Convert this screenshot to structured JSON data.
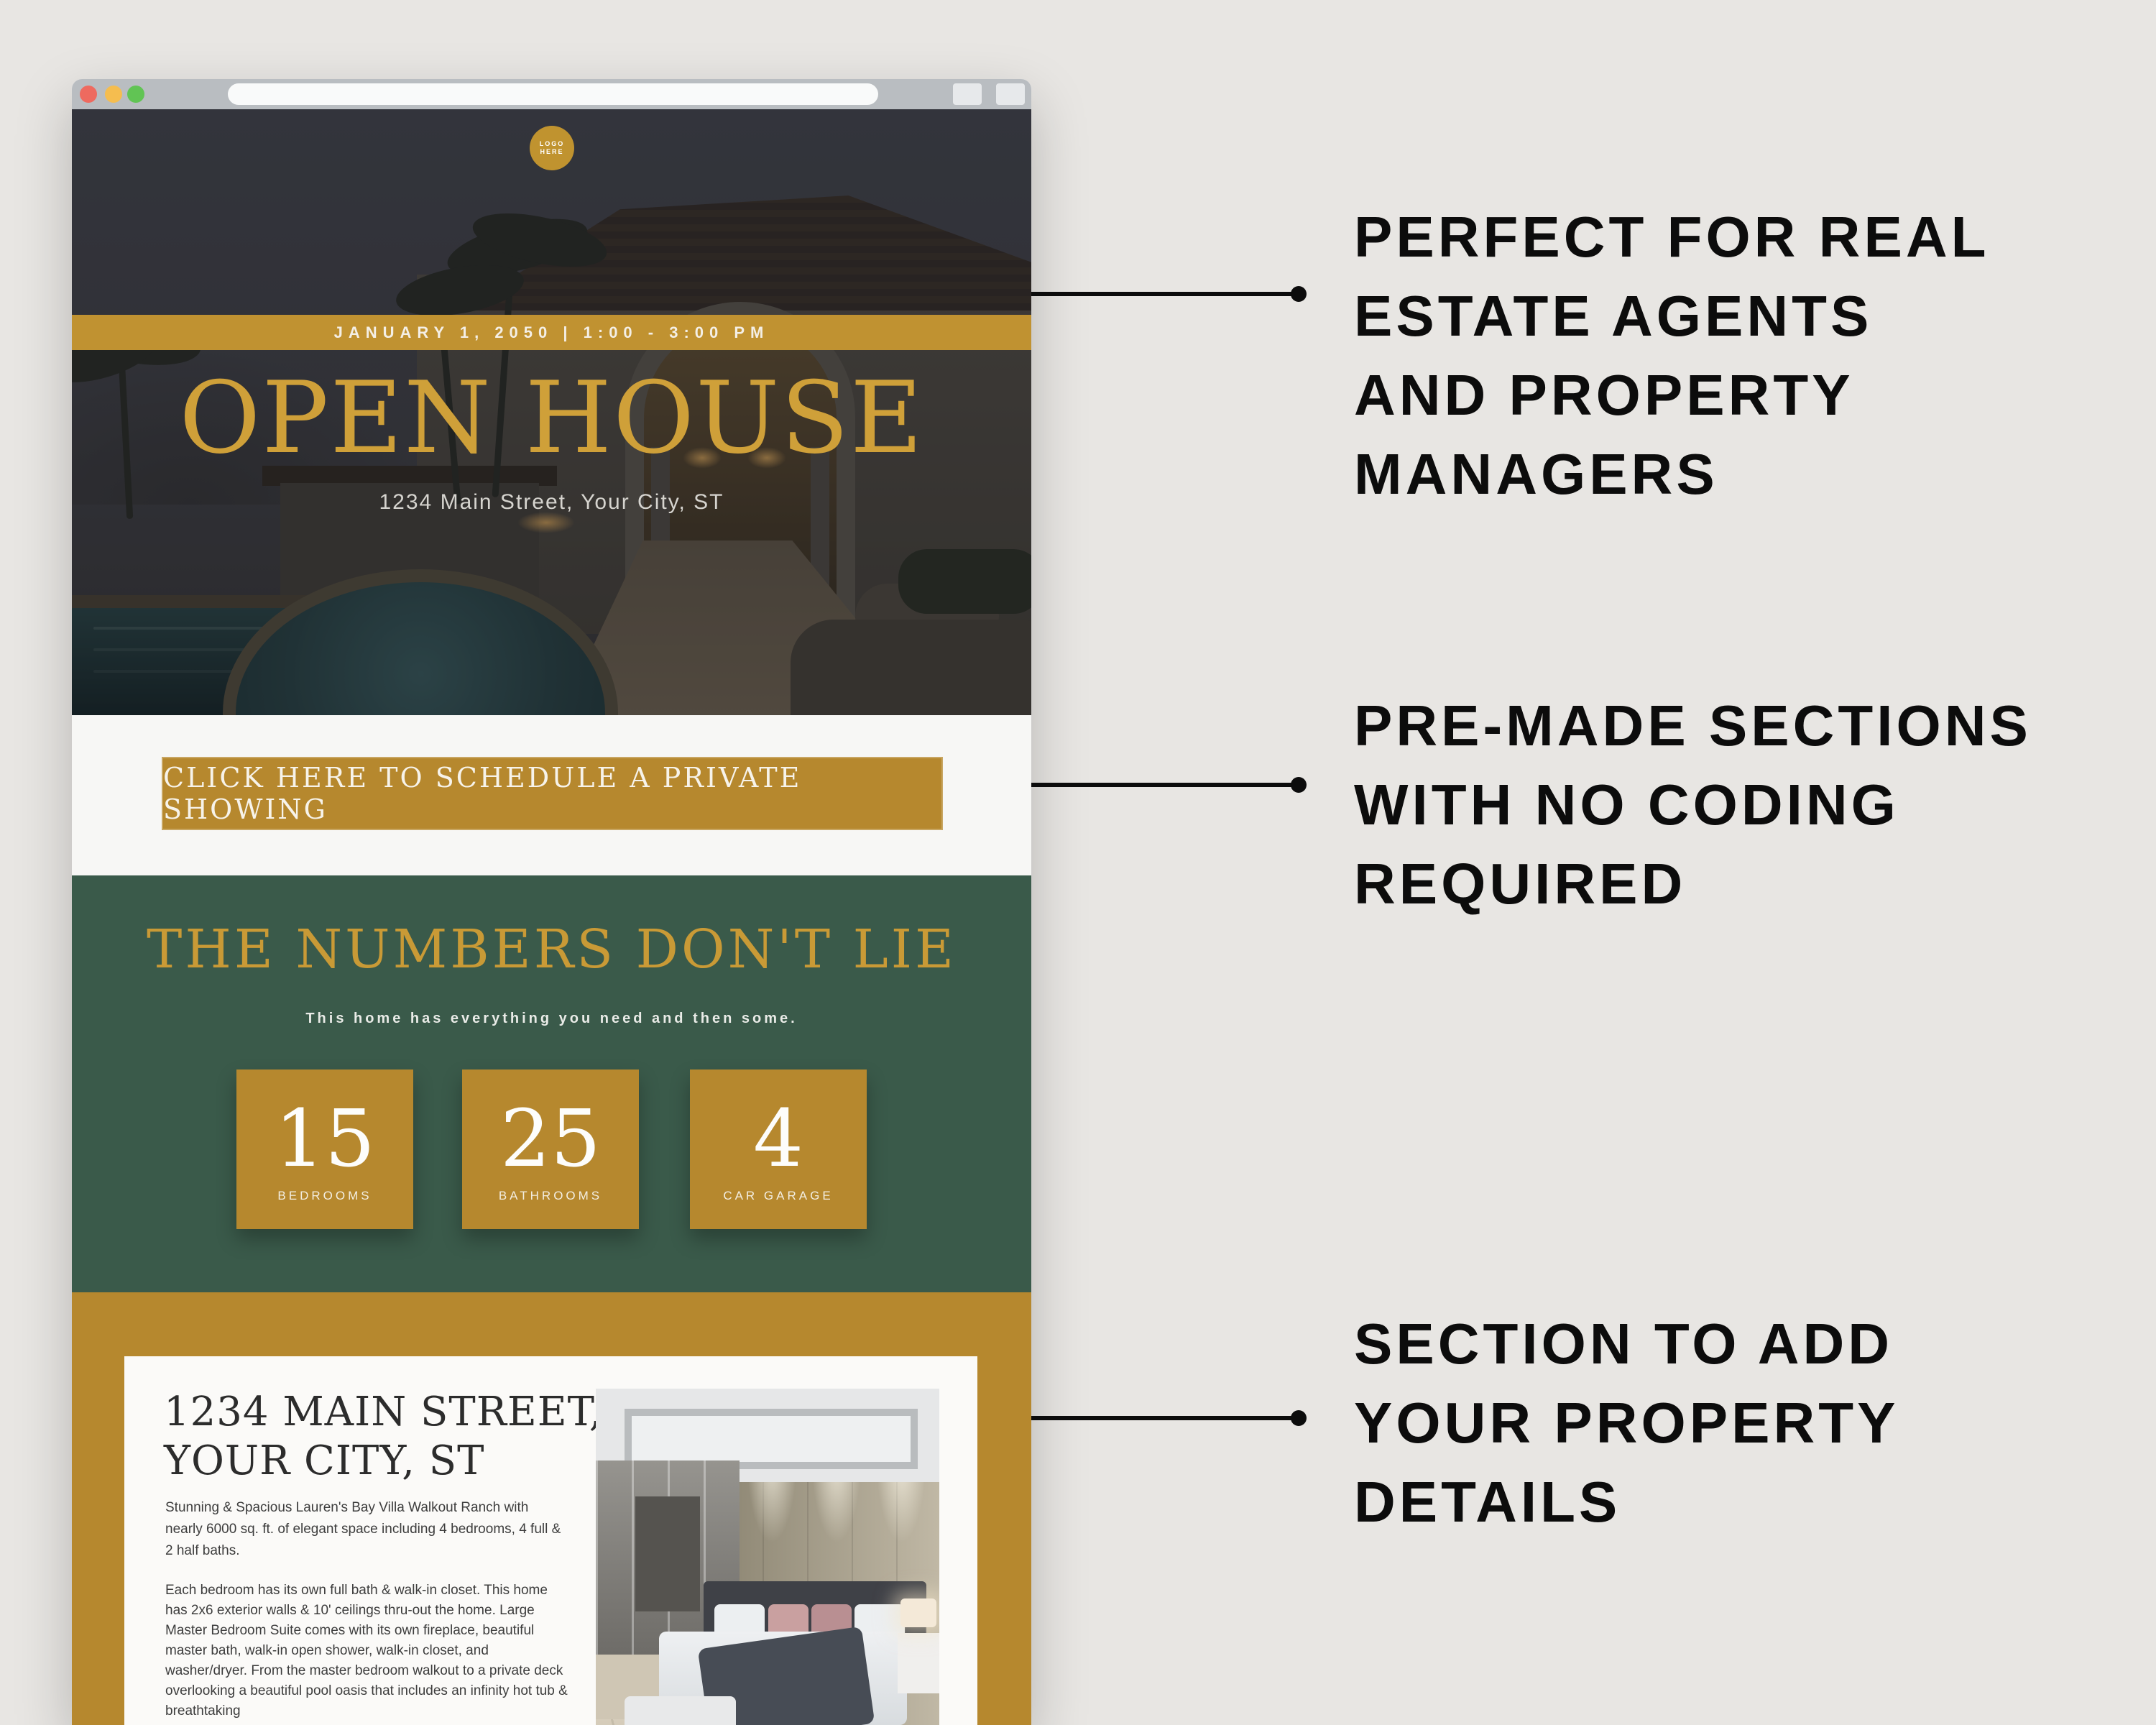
{
  "browser": {
    "url_value": "",
    "controls": {
      "close": "close",
      "minimize": "minimize",
      "maximize": "maximize"
    }
  },
  "hero": {
    "logo_line1": "LOGO",
    "logo_line2": "HERE",
    "banner": "JANUARY 1, 2050   |   1:00 - 3:00 PM",
    "title": "OPEN HOUSE",
    "address": "1234 Main Street, Your City, ST"
  },
  "cta": {
    "label": "CLICK HERE TO SCHEDULE A PRIVATE SHOWING"
  },
  "numbers": {
    "title": "THE NUMBERS DON'T LIE",
    "subtitle": "This home has everything you need and then some.",
    "stats": [
      {
        "value": "15",
        "label": "BEDROOMS"
      },
      {
        "value": "25",
        "label": "BATHROOMS"
      },
      {
        "value": "4",
        "label": "CAR GARAGE"
      }
    ]
  },
  "property": {
    "heading_line1": "1234 MAIN STREET,",
    "heading_line2": "YOUR CITY, ST",
    "para1": "Stunning & Spacious Lauren's Bay Villa Walkout Ranch with nearly 6000 sq. ft. of elegant space including 4 bedrooms, 4 full & 2 half baths.",
    "para2": "Each bedroom has its own full bath & walk-in closet. This home has 2x6 exterior walls & 10' ceilings thru-out the home. Large Master Bedroom Suite comes with its own fireplace, beautiful master bath, walk-in open shower, walk-in closet, and washer/dryer. From the master bedroom walkout to a private deck overlooking a beautiful pool oasis that includes an infinity hot tub & breathtaking"
  },
  "annotations": [
    {
      "lines": [
        "PERFECT FOR REAL",
        "ESTATE AGENTS",
        "AND PROPERTY",
        "MANAGERS"
      ]
    },
    {
      "lines": [
        "PRE-MADE SECTIONS",
        "WITH NO CODING",
        "REQUIRED"
      ]
    },
    {
      "lines": [
        "SECTION TO ADD",
        "YOUR PROPERTY",
        "DETAILS"
      ]
    }
  ],
  "colors": {
    "gold": "#b6882e",
    "gold_bright": "#c99a36",
    "banner_gold": "#c09231",
    "green": "#3a5a4a",
    "page_background": "#e8e6e3",
    "annotation_text": "#0c0c0c",
    "card_background": "#fbfaf8"
  }
}
